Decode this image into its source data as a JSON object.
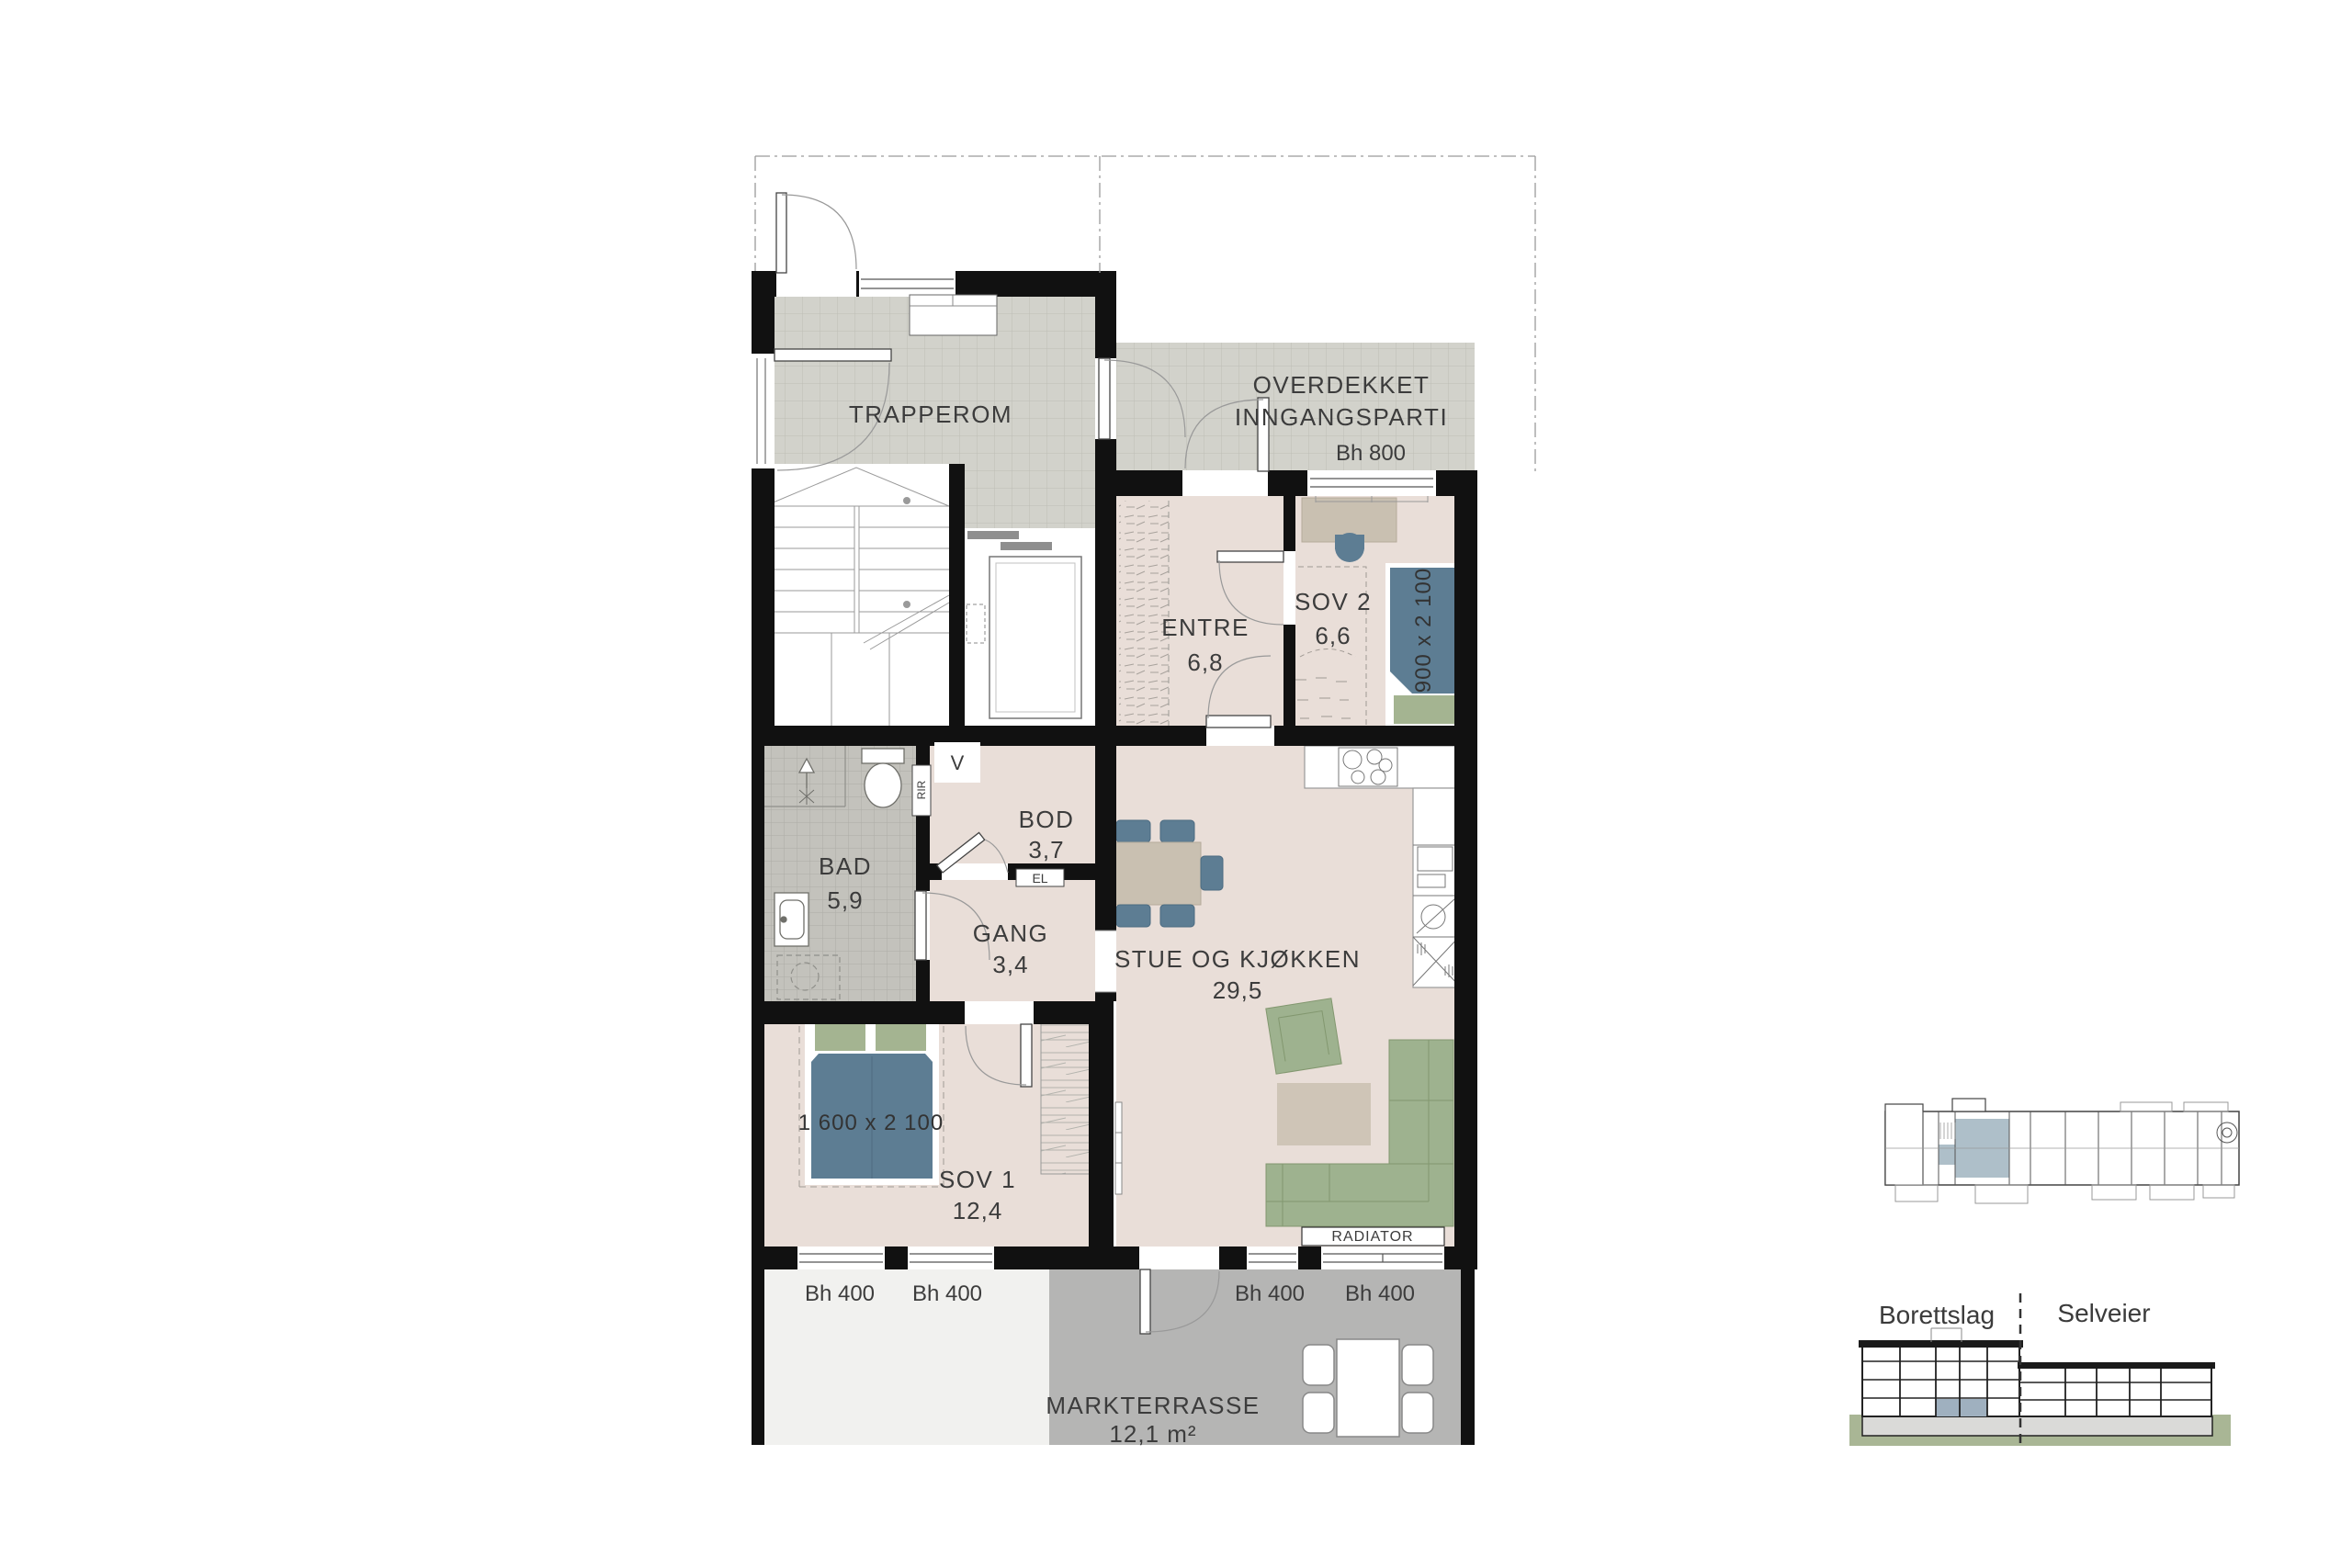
{
  "floorplan": {
    "rooms": {
      "trapperom": {
        "label": "TRAPPEROM"
      },
      "overdekket_inngangsparti": {
        "label_line1": "OVERDEKKET",
        "label_line2": "INNGANGSPARTI",
        "window_height": "Bh 800"
      },
      "entre": {
        "label": "ENTRE",
        "area": "6,8"
      },
      "sov2": {
        "label": "SOV 2",
        "area": "6,6",
        "bed_size": "900 x 2 100"
      },
      "bod": {
        "label": "BOD",
        "area": "3,7"
      },
      "gang": {
        "label": "GANG",
        "area": "3,4"
      },
      "bad": {
        "label": "BAD",
        "area": "5,9"
      },
      "stue_og_kjokken": {
        "label": "STUE OG KJØKKEN",
        "area": "29,5"
      },
      "sov1": {
        "label": "SOV 1",
        "area": "12,4",
        "bed_size": "1 600 x 2 100"
      },
      "markterrasse": {
        "label": "MARKTERRASSE",
        "area": "12,1 m²"
      }
    },
    "annotations": {
      "window_height_400": "Bh 400",
      "radiator": "RADIATOR",
      "ventilation": "V",
      "electrical": "EL",
      "duct": "RIR"
    },
    "section_legend": {
      "left": "Borettslag",
      "right": "Selveier"
    },
    "colors": {
      "wall": "#111111",
      "apartment_floor": "#e9ded8",
      "tile_floor": "#d2d2cb",
      "bathroom_floor": "#c3c2bc",
      "terrace": "#b5b5b4",
      "light_terrace": "#f1f1ef",
      "bed_blue": "#5d7d93",
      "furniture_green": "#9eb28f",
      "furniture_beige": "#c9c0b1",
      "highlight_unit": "#aebfc9",
      "ground_green": "#a9b695"
    }
  }
}
